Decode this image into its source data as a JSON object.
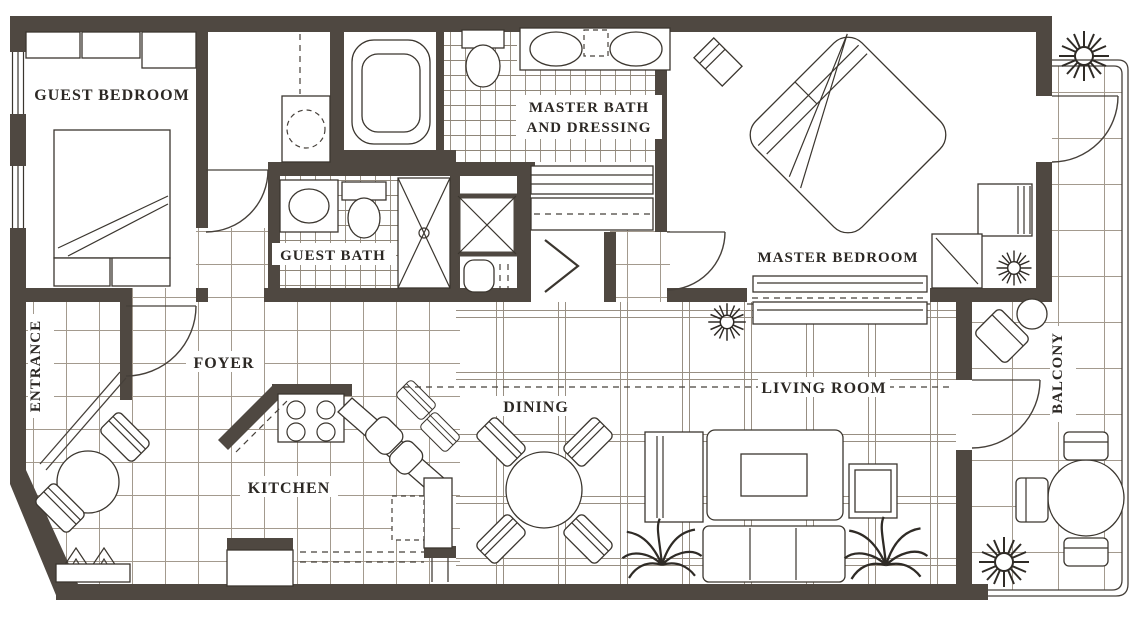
{
  "plan": {
    "title": "Two-bedroom condominium floor plan",
    "rooms": {
      "guest_bedroom": "GUEST BEDROOM",
      "master_bath_line1": "MASTER BATH",
      "master_bath_line2": "AND DRESSING",
      "guest_bath": "GUEST BATH",
      "master_bedroom": "MASTER BEDROOM",
      "entrance": "ENTRANCE",
      "foyer": "FOYER",
      "kitchen": "KITCHEN",
      "dining": "DINING",
      "living_room": "LIVING ROOM",
      "balcony": "BALCONY"
    },
    "colors": {
      "wall": "#4f4841",
      "line": "#3b362f",
      "tile_grid": "#a39a8e",
      "background": "#ffffff",
      "text": "#2c2824"
    }
  }
}
